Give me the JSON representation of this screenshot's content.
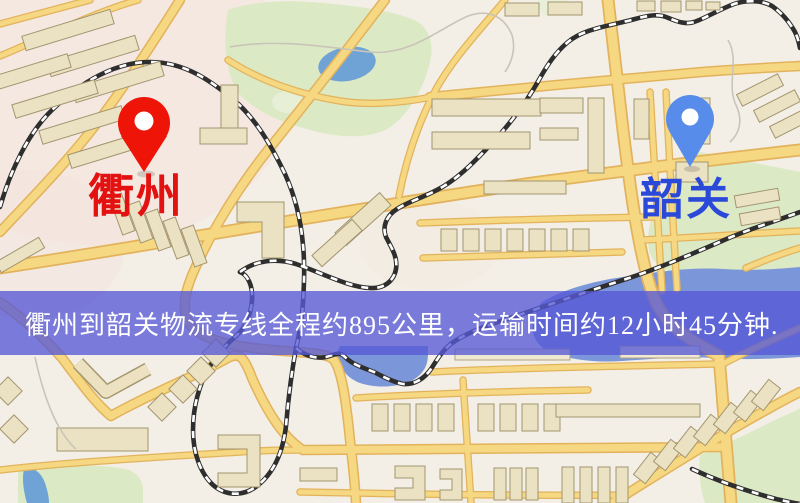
{
  "map": {
    "origin": {
      "name": "衢州",
      "pin_color": "#ee1407",
      "label_color": "#e41111"
    },
    "destination": {
      "name": "韶关",
      "pin_color": "#578ceb",
      "label_color": "#2b49d9"
    },
    "banner": {
      "text": "衢州到韶关物流专线全程约895公里，运输时间约12小时45分钟.",
      "distance_km": "895",
      "duration": "12小时45分钟",
      "background_color": "rgba(86,88,214,0.78)",
      "text_color": "#ffffff"
    },
    "palette": {
      "background": "#f3efe6",
      "road_fill": "#f6d782",
      "road_casing": "#e2b35c",
      "railway": "#2e2e2e",
      "water": "#7c97d9",
      "pond": "#6fa3d6",
      "park": "#dce9c5",
      "building": "#ebe2c4"
    }
  }
}
